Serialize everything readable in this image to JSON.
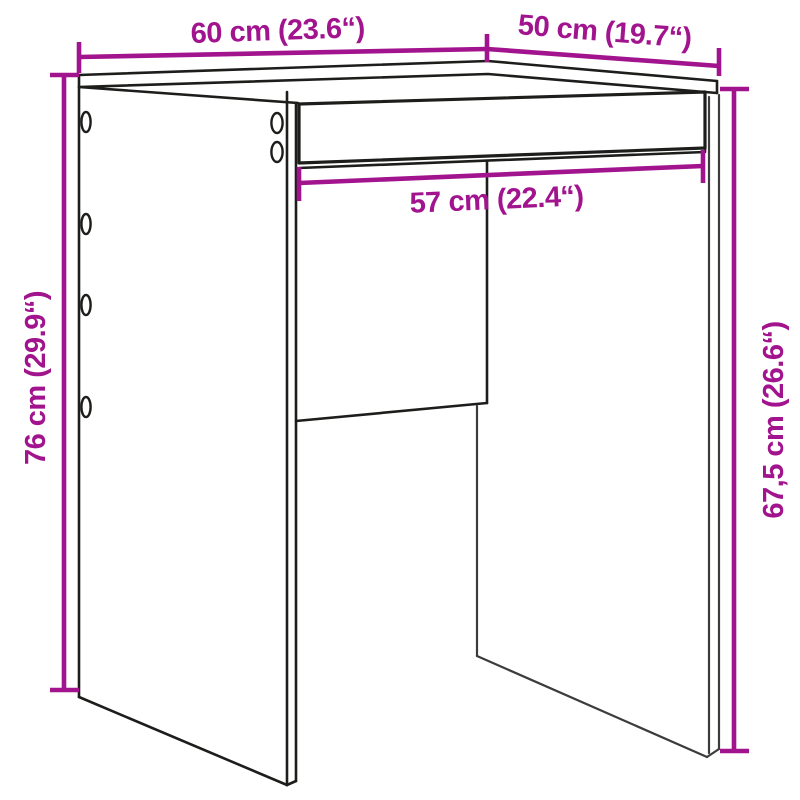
{
  "diagram": {
    "kind": "furniture-dimension-line-drawing",
    "dimensions": {
      "top_width": {
        "label": "60 cm (23.6“)"
      },
      "top_depth": {
        "label": "50 cm (19.7“)"
      },
      "inner_width": {
        "label": "57 cm (22.4“)"
      },
      "height_total": {
        "label": "76 cm (29.9“)"
      },
      "height_under": {
        "label": "67,5 cm (26.6“)"
      }
    },
    "colors": {
      "dimension_accent": "#A2138E",
      "outline": "#1D1D1B"
    }
  }
}
